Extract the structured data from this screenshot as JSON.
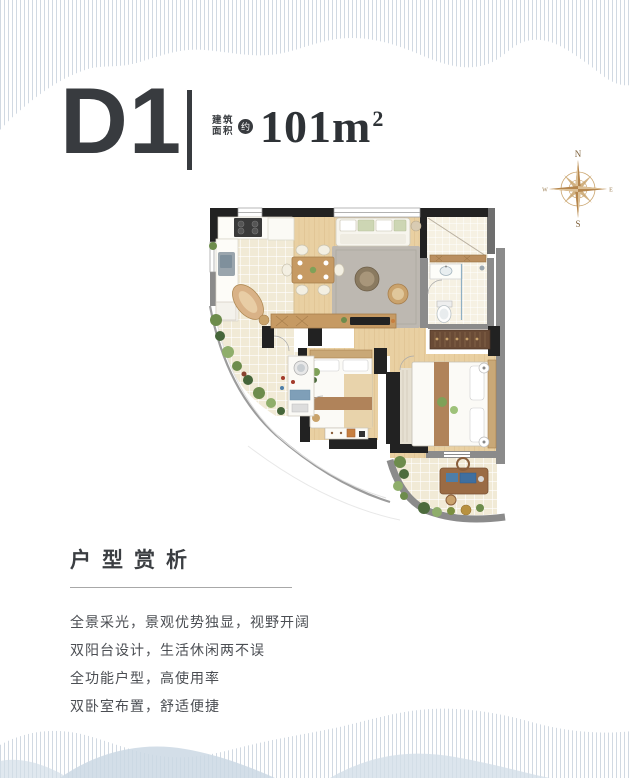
{
  "header": {
    "plan_code": "D1",
    "area_label_line1": "建筑",
    "area_label_line2": "面积",
    "approx_badge": "约",
    "area_value": "101m",
    "area_exponent": "2"
  },
  "compass": {
    "north": "N",
    "south": "S",
    "east": "E",
    "west": "W"
  },
  "section": {
    "title": "户型赏析"
  },
  "features": [
    "全景采光，景观优势独显，视野开阔",
    "双阳台设计，生活休闲两不误",
    "全功能户型，高使用率",
    "双卧室布置，舒适便捷"
  ],
  "colors": {
    "ink": "#383b3f",
    "body_text": "#4b4e53",
    "compass_gold": "#b5864d",
    "stripe_blue": "#c2cdd8",
    "hill_blue": "#cbd8e4",
    "wood": "#e9d0a2",
    "wall_dark": "#222222",
    "wall_gray": "#8b8b8b"
  }
}
